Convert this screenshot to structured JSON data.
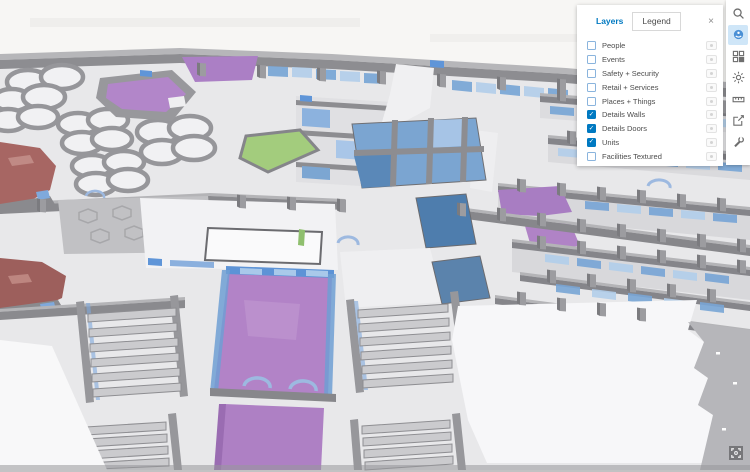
{
  "panel": {
    "tabs": [
      {
        "label": "Layers",
        "active": true
      },
      {
        "label": "Legend",
        "active": false
      }
    ],
    "close_label": "×",
    "check_glyph": "✓",
    "layers": [
      {
        "label": "People",
        "checked": false
      },
      {
        "label": "Events",
        "checked": false
      },
      {
        "label": "Safety + Security",
        "checked": false
      },
      {
        "label": "Retail + Services",
        "checked": false
      },
      {
        "label": "Places + Things",
        "checked": false
      },
      {
        "label": "Details Walls",
        "checked": true
      },
      {
        "label": "Details Doors",
        "checked": true
      },
      {
        "label": "Units",
        "checked": true
      },
      {
        "label": "Facilities Textured",
        "checked": false
      }
    ]
  },
  "toolbar": {
    "icons": [
      {
        "name": "search",
        "active": false
      },
      {
        "name": "layers-globe",
        "active": true
      },
      {
        "name": "basemap",
        "active": false
      },
      {
        "name": "daylight",
        "active": false
      },
      {
        "name": "measure",
        "active": false
      },
      {
        "name": "share",
        "active": false
      },
      {
        "name": "tools",
        "active": false
      }
    ]
  },
  "map": {
    "type": "3d-indoor-scene",
    "colors": {
      "accent_blue": "#0079c1",
      "unit_purple": "#b283c7",
      "unit_blue": "#7ba5d1",
      "unit_dark_blue": "#4e7dad",
      "unit_green": "#a3cc7d",
      "unit_red": "#a76663",
      "glass_blue": "#79a6d6",
      "wall_gray": "#8d8d91",
      "floor_gray": "#e8e8ea",
      "sky": "#f7f6f4"
    }
  }
}
